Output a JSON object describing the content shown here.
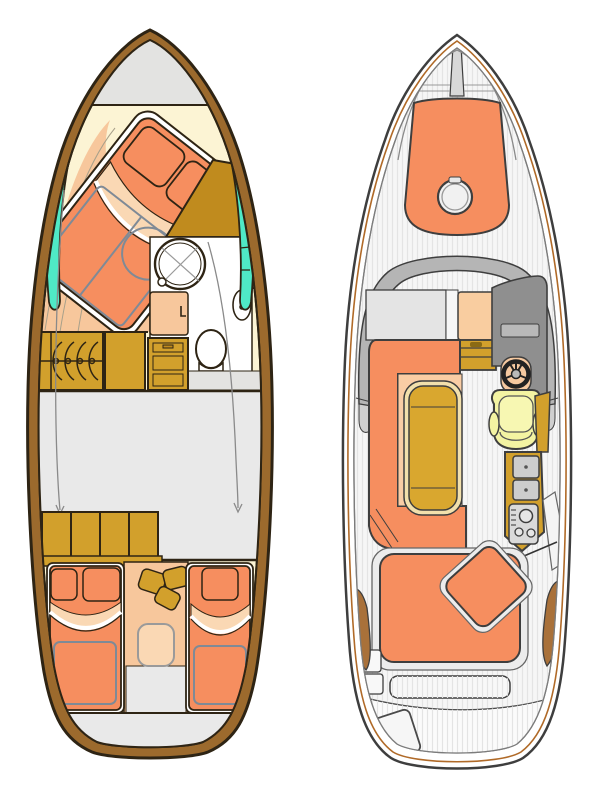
{
  "palette": {
    "background": "#ffffff",
    "hull_wood": "#9c6a2d",
    "outline_dark": "#2e2414",
    "cream": "#fcf4d4",
    "deck_gray": "#e3e3e1",
    "mid_gray": "#e9e9e9",
    "teal": "#4fe9c6",
    "orange": "#f68e5f",
    "peach": "#f7c79c",
    "peach_light": "#fad8b4",
    "gold": "#d2a02c",
    "gold_dark": "#c08b1e",
    "slate": "#7f8a96",
    "right_outline": "#3e3e3e",
    "windshield_gray": "#b5b5b5",
    "dashboard_gray": "#8f8f8f",
    "panel_gray": "#d8d8d8",
    "seat_yellow": "#f3f3a2",
    "wood_brown": "#a9713a",
    "table_gold": "#d9a72f",
    "table_rim": "#f2e0ac",
    "stripe_gray": "#e4e4e4"
  },
  "scene": {
    "type": "yacht-deck-floor-plans",
    "views": [
      {
        "id": "lower-deck-plan",
        "parts": [
          "hull",
          "bow-deck",
          "owner-cabin-double-bed",
          "pillows",
          "blanket-fold",
          "under-bed-outline",
          "wardrobe",
          "bathroom",
          "washbasin",
          "toilet",
          "shower-mixer",
          "bathroom-door",
          "galley-cabinets",
          "cabinet-hinge-arcs",
          "drawer-unit",
          "hull-window-port",
          "hull-window-starboard",
          "saloon-area",
          "walkway-guide-lines",
          "aft-wardrobe",
          "aft-corridor",
          "corridor-stools",
          "companionway-step",
          "guest-bed-port",
          "guest-bed-starboard",
          "stern-deck"
        ]
      },
      {
        "id": "main-deck-plan",
        "parts": [
          "hull",
          "rub-rail",
          "bow-deck-planks",
          "anchor-locker-seam",
          "bow-sunpad",
          "deck-hatch",
          "windshield",
          "cabin-roof",
          "companionway",
          "companionway-steps",
          "helm-dashboard",
          "instrument-panel",
          "steering-wheel",
          "helm-seat",
          "side-console",
          "galley-counter",
          "sink-hatches",
          "stove",
          "cockpit-sofa",
          "cockpit-table",
          "aft-sunpad",
          "sunpad-backrest",
          "aft-bench",
          "swim-platform",
          "boarding-step",
          "side-step-boxes",
          "wood-trim-port",
          "wood-trim-starboard"
        ]
      }
    ]
  }
}
